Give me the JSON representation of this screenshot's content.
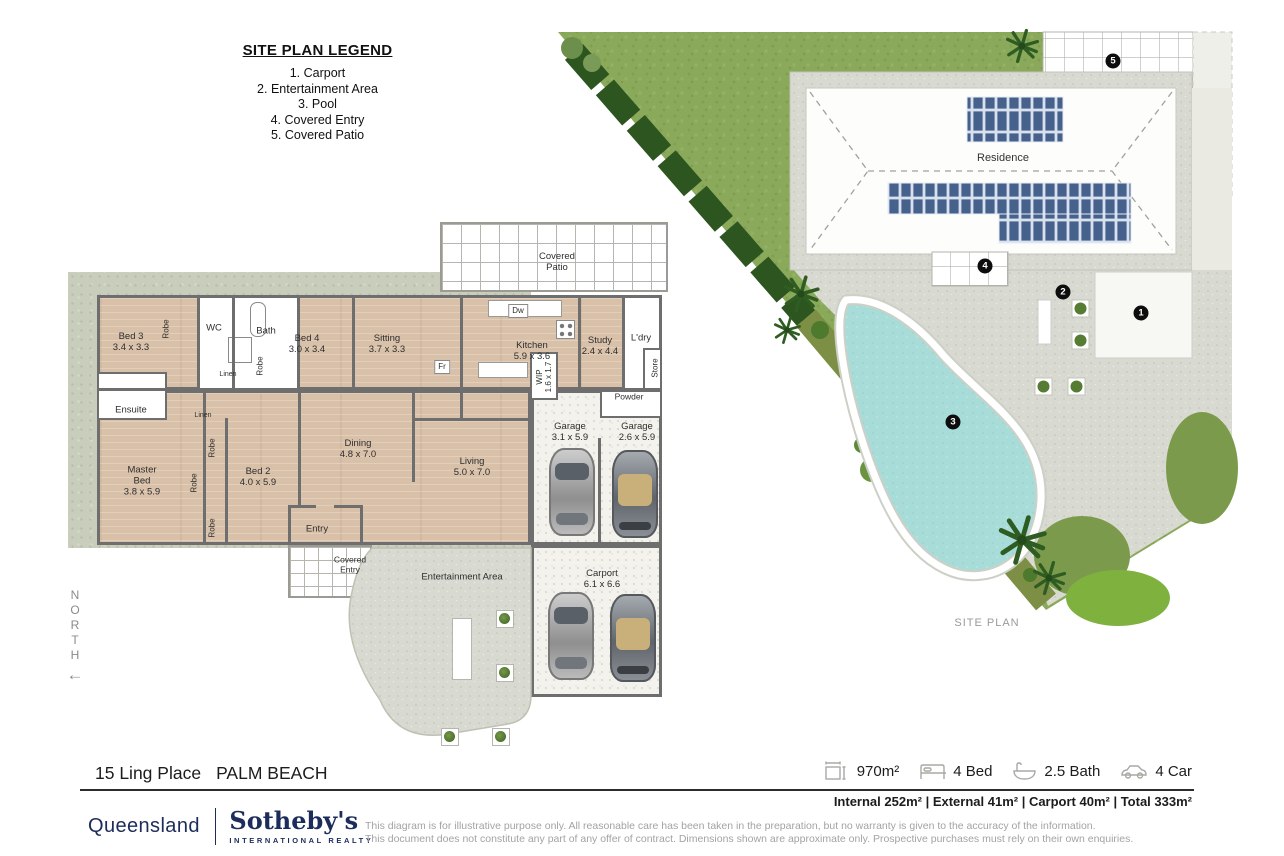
{
  "legend": {
    "title": "SITE PLAN LEGEND",
    "items": [
      "1. Carport",
      "2. Entertainment Area",
      "3. Pool",
      "4. Covered Entry",
      "5. Covered Patio"
    ]
  },
  "north": {
    "label": "NORTH",
    "arrow": "←"
  },
  "floorplan": {
    "labels": [
      {
        "t": "Bed 3\n3.4 x 3.3",
        "x": 131,
        "y": 342
      },
      {
        "t": "WC",
        "x": 214,
        "y": 328
      },
      {
        "t": "Bath",
        "x": 266,
        "y": 331
      },
      {
        "t": "Bed 4\n3.0 x 3.4",
        "x": 307,
        "y": 344
      },
      {
        "t": "Sitting\n3.7 x 3.3",
        "x": 387,
        "y": 344
      },
      {
        "t": "Kitchen\n5.9 x 3.6",
        "x": 532,
        "y": 351
      },
      {
        "t": "Study\n2.4 x 4.4",
        "x": 600,
        "y": 346
      },
      {
        "t": "L'dry",
        "x": 641,
        "y": 338
      },
      {
        "t": "Powder",
        "x": 629,
        "y": 397,
        "cls": "small"
      },
      {
        "t": "Ensuite",
        "x": 131,
        "y": 410
      },
      {
        "t": "Master\nBed\n3.8 x 5.9",
        "x": 142,
        "y": 481
      },
      {
        "t": "Bed 2\n4.0 x 5.9",
        "x": 258,
        "y": 477
      },
      {
        "t": "Dining\n4.8 x 7.0",
        "x": 358,
        "y": 449
      },
      {
        "t": "Living\n5.0 x 7.0",
        "x": 472,
        "y": 467
      },
      {
        "t": "Garage\n3.1 x 5.9",
        "x": 570,
        "y": 432
      },
      {
        "t": "Garage\n2.6 x 5.9",
        "x": 637,
        "y": 432
      },
      {
        "t": "Entry",
        "x": 317,
        "y": 529
      },
      {
        "t": "Covered\nEntry",
        "x": 350,
        "y": 565,
        "cls": "small"
      },
      {
        "t": "Covered\nPatio",
        "x": 557,
        "y": 262
      },
      {
        "t": "Entertainment Area",
        "x": 462,
        "y": 577
      },
      {
        "t": "Carport\n6.1 x 6.6",
        "x": 602,
        "y": 579
      },
      {
        "t": "Robe",
        "x": 166,
        "y": 329,
        "cls": "v"
      },
      {
        "t": "Robe",
        "x": 260,
        "y": 366,
        "cls": "v"
      },
      {
        "t": "Linen",
        "x": 228,
        "y": 375,
        "cls": "tiny"
      },
      {
        "t": "Linen",
        "x": 203,
        "y": 416,
        "cls": "tiny"
      },
      {
        "t": "Robe",
        "x": 212,
        "y": 448,
        "cls": "v"
      },
      {
        "t": "Robe",
        "x": 194,
        "y": 483,
        "cls": "v"
      },
      {
        "t": "Robe",
        "x": 212,
        "y": 528,
        "cls": "v"
      },
      {
        "t": "Fr",
        "x": 442,
        "y": 367,
        "cls": "box"
      },
      {
        "t": "Dw",
        "x": 518,
        "y": 311,
        "cls": "box"
      },
      {
        "t": "WIP\n1.6 x 1.7",
        "x": 544,
        "y": 377,
        "cls": "v"
      },
      {
        "t": "Store",
        "x": 655,
        "y": 368,
        "cls": "v"
      }
    ]
  },
  "siteplan": {
    "residence_label": "Residence",
    "caption": "SITE PLAN",
    "markers": [
      {
        "n": "1",
        "x": 1141,
        "y": 313
      },
      {
        "n": "2",
        "x": 1063,
        "y": 292
      },
      {
        "n": "3",
        "x": 953,
        "y": 422
      },
      {
        "n": "4",
        "x": 985,
        "y": 266
      },
      {
        "n": "5",
        "x": 1113,
        "y": 61
      }
    ]
  },
  "footer": {
    "address_street": "15 Ling Place",
    "address_suburb": "PALM BEACH",
    "stats": [
      {
        "icon": "land-area-icon",
        "value": "970m²"
      },
      {
        "icon": "bed-icon",
        "value": "4 Bed"
      },
      {
        "icon": "bath-icon",
        "value": "2.5 Bath"
      },
      {
        "icon": "car-icon",
        "value": "4 Car"
      }
    ],
    "areas": "Internal 252m² | External 41m² | Carport 40m² | Total 333m²",
    "brand": {
      "region": "Queensland",
      "name": "Sotheby's",
      "subtitle": "INTERNATIONAL REALTY"
    },
    "disclaimer1": "This diagram is for illustrative purpose only. All reasonable care has been taken in the preparation, but no warranty is given to the accuracy of the information.",
    "disclaimer2": "This document does not constitute any part of any offer of contract. Dimensions shown are approximate only. Prospective purchases must rely on their own enquiries."
  }
}
